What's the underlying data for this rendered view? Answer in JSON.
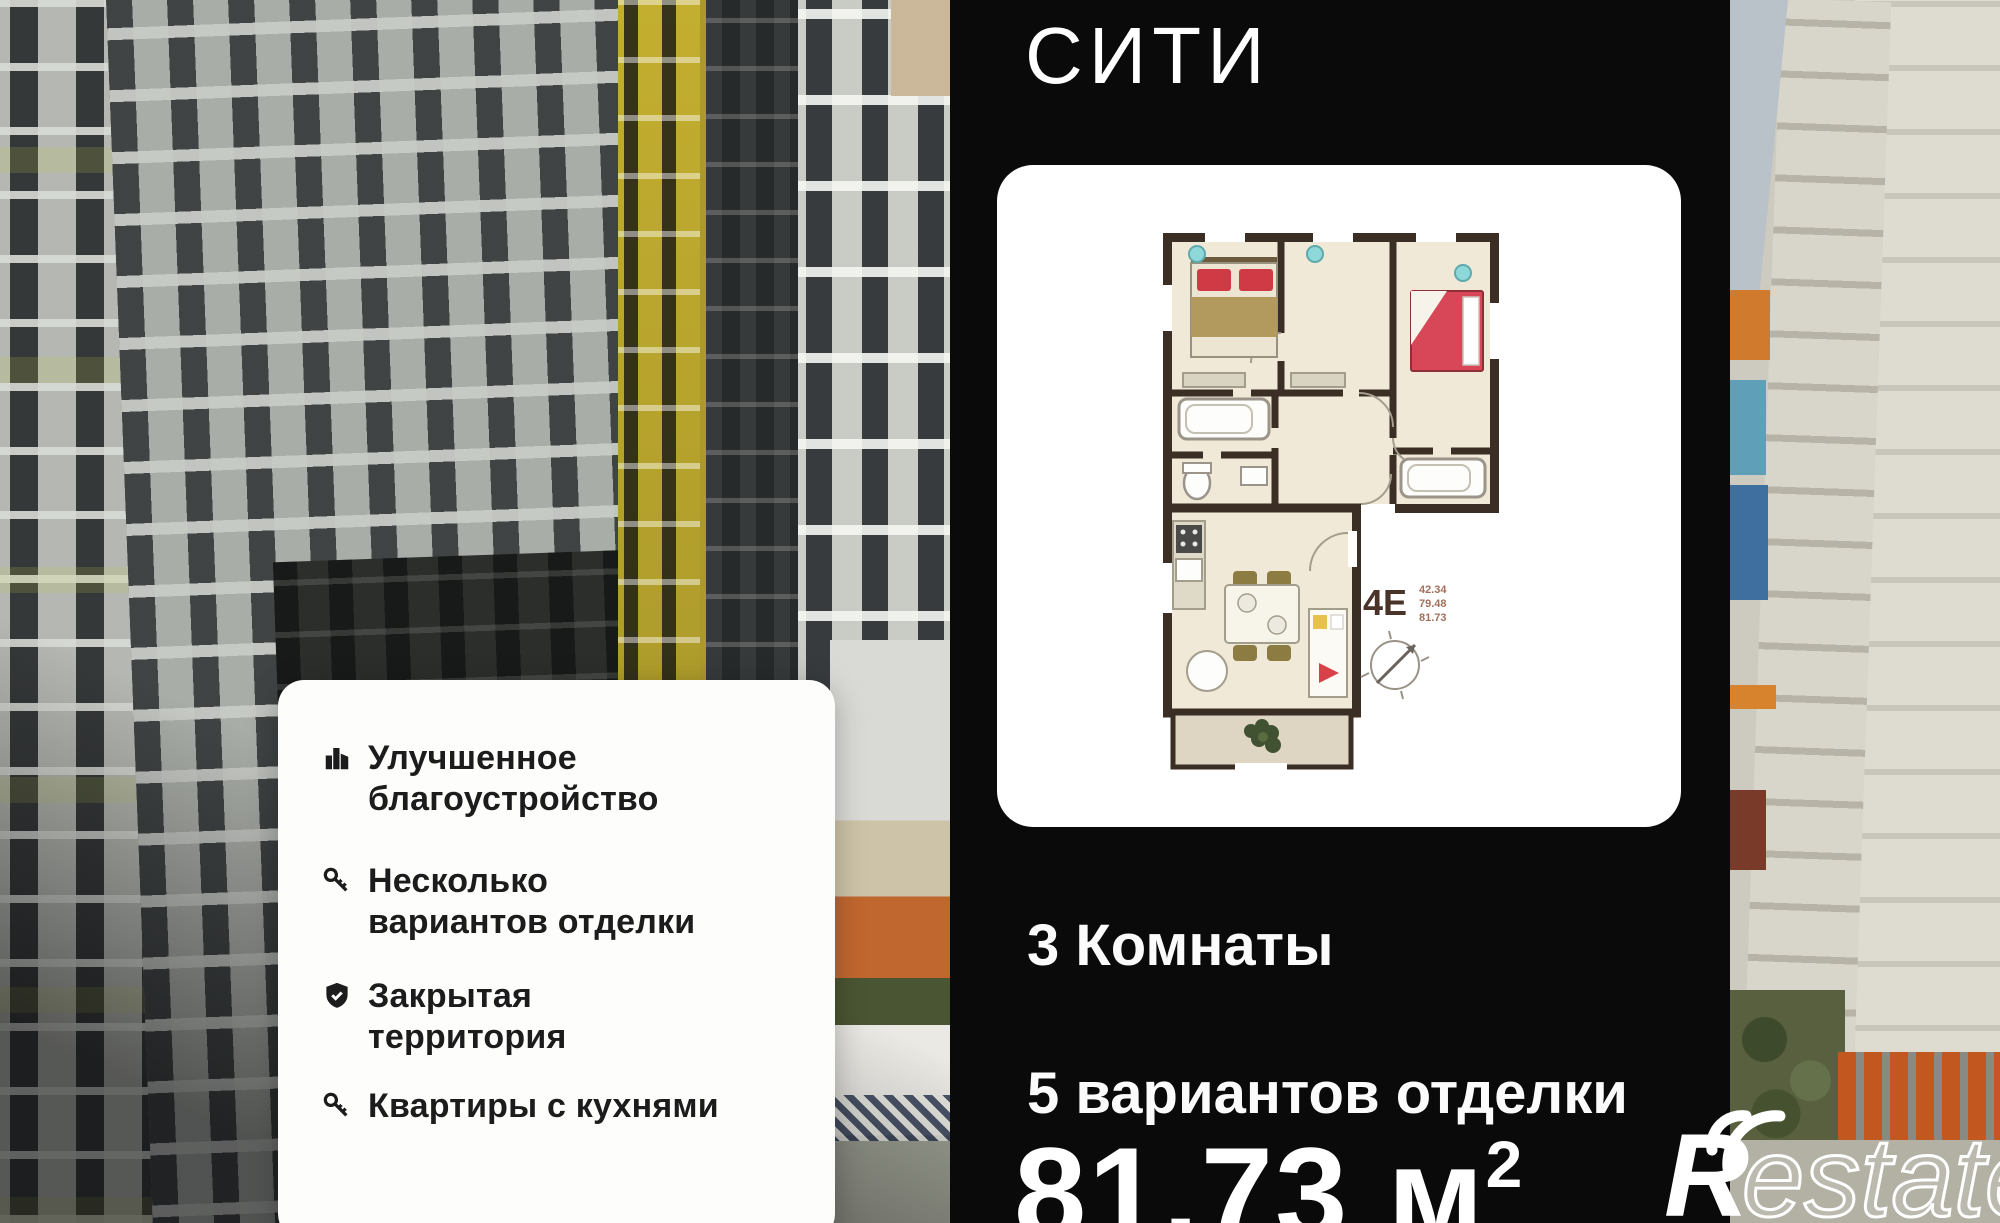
{
  "brand": {
    "title_line1": "ЛЮТЕН",
    "title_line2": "СИТИ"
  },
  "features": [
    {
      "icon": "buildings-icon",
      "label": "Улучшенное\nблагоустройство"
    },
    {
      "icon": "key-icon",
      "label": "Несколько\nвариантов отделки"
    },
    {
      "icon": "shield-check-icon",
      "label": "Закрытая\nтерритория"
    },
    {
      "icon": "key-icon",
      "label": "Квартиры с кухнями"
    }
  ],
  "plan": {
    "type_label": "4Е",
    "area_list": [
      "42.34",
      "79.48",
      "81.73"
    ]
  },
  "listing": {
    "rooms": "3 Комнаты",
    "finishes": "5 вариантов отделки",
    "area_value": "81.73",
    "area_unit": " м",
    "area_superscript": "2"
  },
  "watermark": {
    "initial": "R",
    "rest": "estate"
  },
  "colors": {
    "panel_background": "#0a0a0b",
    "plan_wall": "#3b2e25",
    "plan_floor": "#f0e9d7",
    "bed_red": "#d84757",
    "yellow_building": "#b8a42e",
    "playground_orange": "#c0662f"
  }
}
